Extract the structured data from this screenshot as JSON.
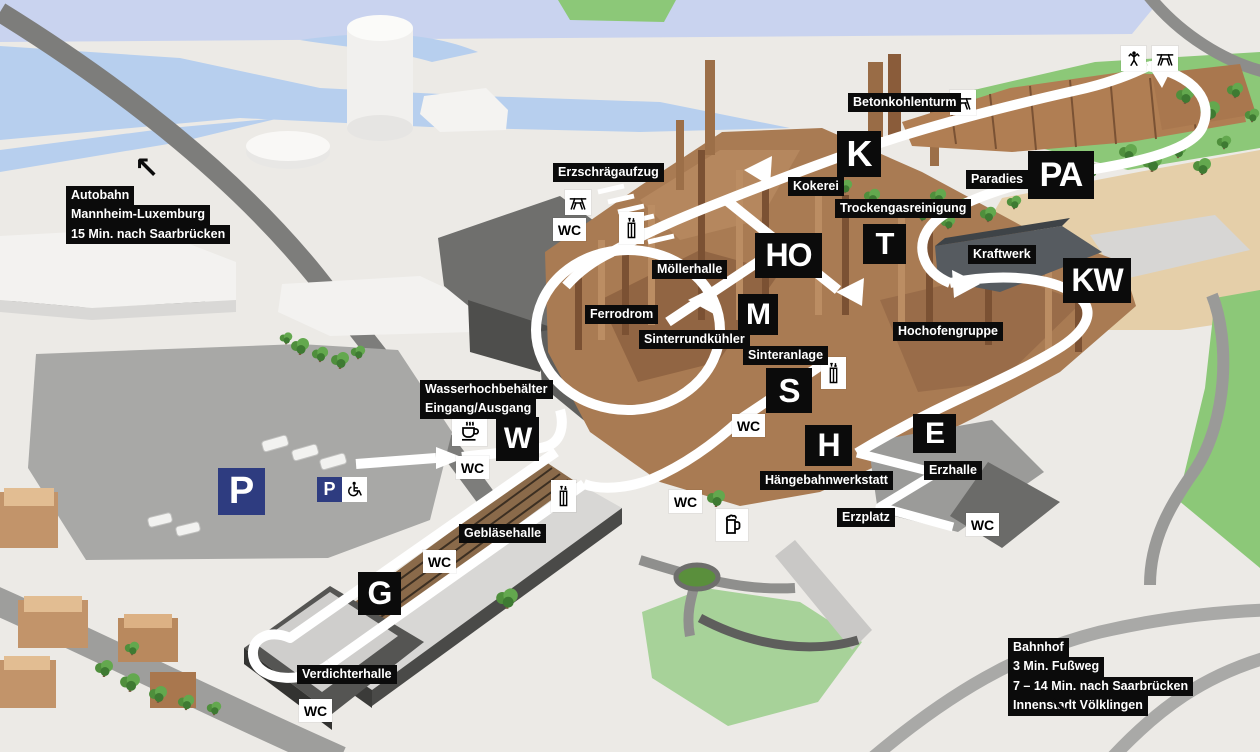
{
  "map": {
    "wc_text": "WC",
    "colors": {
      "label_bg": "#0b0b0b",
      "label_text": "#ffffff",
      "parking_blue": "#2e3c80",
      "route_white": "#ffffff",
      "water_blue": "#b7cfee",
      "sky_band": "#c9d3ef",
      "grass_green": "#8cc878",
      "lawn_light_green": "#a7d299",
      "sand_tan": "#e5cfa9",
      "copper": "#a97b53",
      "ground_gray": "#eceae6"
    },
    "region_labels": [
      {
        "name": "betonkohlenturm",
        "lines": [
          "Betonkohlenturm"
        ],
        "x": 848,
        "y": 93
      },
      {
        "name": "erzschraegaufzug",
        "lines": [
          "Erzschrägaufzug"
        ],
        "x": 553,
        "y": 163
      },
      {
        "name": "kokerei",
        "lines": [
          "Kokerei"
        ],
        "x": 788,
        "y": 177
      },
      {
        "name": "trockengasreinigung",
        "lines": [
          "Trockengasreinigung"
        ],
        "x": 835,
        "y": 199
      },
      {
        "name": "paradies",
        "lines": [
          "Paradies"
        ],
        "x": 966,
        "y": 170
      },
      {
        "name": "kraftwerk",
        "lines": [
          "Kraftwerk"
        ],
        "x": 968,
        "y": 245
      },
      {
        "name": "moellerhalle",
        "lines": [
          "Möllerhalle"
        ],
        "x": 652,
        "y": 260
      },
      {
        "name": "ferrodrom",
        "lines": [
          "Ferrodrom"
        ],
        "x": 585,
        "y": 305
      },
      {
        "name": "sinterrundkuehler",
        "lines": [
          "Sinterrundkühler"
        ],
        "x": 639,
        "y": 330
      },
      {
        "name": "sinteranlage",
        "lines": [
          "Sinteranlage"
        ],
        "x": 743,
        "y": 346
      },
      {
        "name": "hochofengruppe",
        "lines": [
          "Hochofengruppe"
        ],
        "x": 893,
        "y": 322
      },
      {
        "name": "wasserhochbehaelter",
        "lines": [
          "Wasserhochbehälter",
          "Eingang/Ausgang"
        ],
        "x": 420,
        "y": 380
      },
      {
        "name": "haengebahnwerkstatt",
        "lines": [
          "Hängebahnwerkstatt"
        ],
        "x": 760,
        "y": 471
      },
      {
        "name": "erzhalle",
        "lines": [
          "Erzhalle"
        ],
        "x": 924,
        "y": 461
      },
      {
        "name": "erzplatz",
        "lines": [
          "Erzplatz"
        ],
        "x": 837,
        "y": 508
      },
      {
        "name": "geblaesehalle",
        "lines": [
          "Gebläsehalle"
        ],
        "x": 459,
        "y": 524
      },
      {
        "name": "verdichterhalle",
        "lines": [
          "Verdichterhalle"
        ],
        "x": 297,
        "y": 665
      }
    ],
    "direction_notes": [
      {
        "name": "autobahn-note",
        "lines": [
          "Autobahn",
          "Mannheim-Luxemburg",
          "15 Min. nach Saarbrücken"
        ],
        "x": 66,
        "y": 186,
        "arrow": "↖",
        "arrow_x": 134,
        "arrow_y": 154
      },
      {
        "name": "bahnhof-note",
        "lines": [
          "Bahnhof",
          "3 Min. Fußweg",
          "7 – 14 Min. nach Saarbrücken",
          "Innenstadt Völklingen"
        ],
        "x": 1008,
        "y": 638,
        "arrow": "↘",
        "arrow_x": 1048,
        "arrow_y": 694
      }
    ],
    "building_badges": [
      {
        "name": "K",
        "letter": "K",
        "x": 837,
        "y": 131,
        "w": 44,
        "h": 46,
        "fs": 36
      },
      {
        "name": "PA",
        "letter": "PA",
        "x": 1028,
        "y": 151,
        "w": 66,
        "h": 48,
        "fs": 34
      },
      {
        "name": "HO",
        "letter": "HO",
        "x": 755,
        "y": 233,
        "w": 67,
        "h": 45,
        "fs": 32
      },
      {
        "name": "T",
        "letter": "T",
        "x": 863,
        "y": 224,
        "w": 43,
        "h": 40,
        "fs": 31
      },
      {
        "name": "KW",
        "letter": "KW",
        "x": 1063,
        "y": 258,
        "w": 68,
        "h": 45,
        "fs": 32
      },
      {
        "name": "M",
        "letter": "M",
        "x": 738,
        "y": 294,
        "w": 40,
        "h": 41,
        "fs": 30
      },
      {
        "name": "S",
        "letter": "S",
        "x": 766,
        "y": 368,
        "w": 46,
        "h": 45,
        "fs": 33
      },
      {
        "name": "H",
        "letter": "H",
        "x": 805,
        "y": 425,
        "w": 47,
        "h": 41,
        "fs": 32
      },
      {
        "name": "E",
        "letter": "E",
        "x": 913,
        "y": 414,
        "w": 43,
        "h": 39,
        "fs": 30
      },
      {
        "name": "G",
        "letter": "G",
        "x": 358,
        "y": 572,
        "w": 43,
        "h": 43,
        "fs": 32
      },
      {
        "name": "W",
        "letter": "W",
        "x": 496,
        "y": 417,
        "w": 43,
        "h": 44,
        "fs": 30
      }
    ],
    "markers": [
      {
        "type": "picnic",
        "x": 950,
        "y": 90
      },
      {
        "type": "climber",
        "x": 1121,
        "y": 46
      },
      {
        "type": "picnic",
        "x": 1152,
        "y": 46
      },
      {
        "type": "picnic",
        "x": 565,
        "y": 190
      },
      {
        "type": "wc",
        "x": 553,
        "y": 218
      },
      {
        "type": "elevator",
        "x": 619,
        "y": 212
      },
      {
        "type": "elevator",
        "x": 821,
        "y": 357
      },
      {
        "type": "coffee",
        "x": 452,
        "y": 416
      },
      {
        "type": "wc",
        "x": 456,
        "y": 456
      },
      {
        "type": "wc",
        "x": 732,
        "y": 414
      },
      {
        "type": "elevator",
        "x": 551,
        "y": 480
      },
      {
        "type": "wc",
        "x": 669,
        "y": 490
      },
      {
        "type": "beer",
        "x": 716,
        "y": 509
      },
      {
        "type": "wc",
        "x": 966,
        "y": 513
      },
      {
        "type": "wc",
        "x": 423,
        "y": 550
      },
      {
        "type": "wc",
        "x": 299,
        "y": 699
      }
    ],
    "parking_main": {
      "label": "P",
      "x": 218,
      "y": 468,
      "size": 47,
      "fs": 38
    },
    "parking_accessible": {
      "label": "P",
      "x": 317,
      "y": 477
    }
  }
}
